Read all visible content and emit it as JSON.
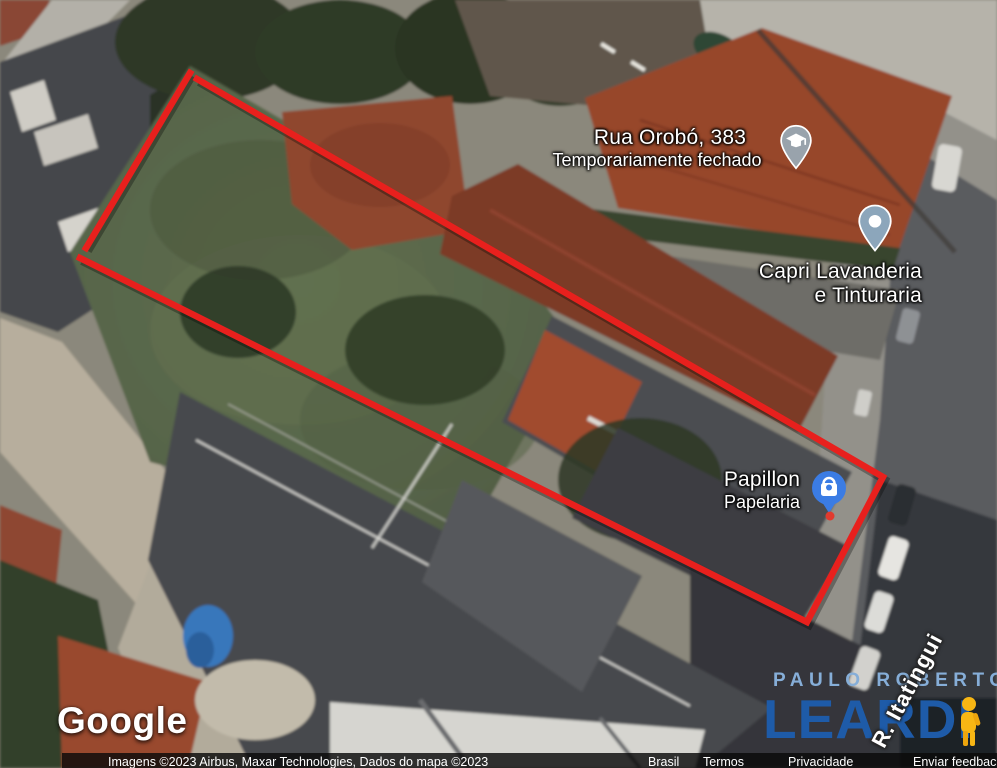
{
  "map": {
    "pois": [
      {
        "title": "Rua Orobó, 383",
        "subtitle": "Temporariamente fechado",
        "icon": "school-pin",
        "pin_color": "#99a3ac"
      },
      {
        "title": "Capri Lavanderia",
        "subtitle": "e Tinturaria",
        "icon": "place-dot-pin",
        "pin_color": "#8ca6bb"
      },
      {
        "title": "Papillon",
        "subtitle": "Papelaria",
        "icon": "shopping-bag-pin",
        "pin_color": "#3b7ce4"
      }
    ],
    "street_label": "R. Itatingui",
    "boundary_color": "#e8201d"
  },
  "branding": {
    "google_logo": "Google"
  },
  "attribution": {
    "copyright": "Imagens ©2023 Airbus, Maxar Technologies, Dados do mapa ©2023",
    "links": [
      "Brasil",
      "Termos",
      "Privacidade",
      "Enviar feedback"
    ]
  },
  "watermark": {
    "line1": "PAULO ROBERTO",
    "line2": "LEARDI"
  }
}
